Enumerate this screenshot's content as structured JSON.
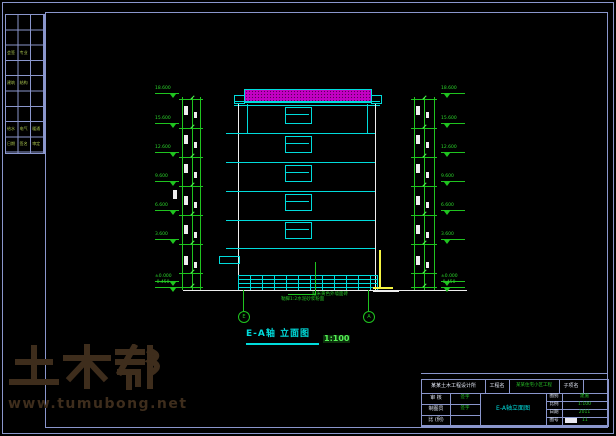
{
  "watermark": {
    "logo_text": "土木帮",
    "url_text": "www.tumubong.net",
    "color": "#3e2d1c"
  },
  "drawing": {
    "title": "E-A轴 立面图",
    "scale": "1:100",
    "levels_left": [
      "18.600",
      "15.600",
      "12.600",
      "9.600",
      "6.600",
      "3.600",
      "±0.000",
      "-0.450"
    ],
    "levels_right": [
      "18.600",
      "15.600",
      "12.600",
      "9.600",
      "6.600",
      "3.600",
      "±0.000",
      "-0.450"
    ],
    "axis_bubbles": [
      "E",
      "A"
    ],
    "material_notes": [
      "贴米黄色外墙面砖",
      "勒脚1:2水泥砂浆粉面"
    ],
    "colors": {
      "line_cyan": "#00dcdc",
      "line_green": "#1fc41f",
      "line_white": "#eeeeee",
      "roof_magenta": "#d400d4",
      "highlight_yellow": "#f5f542",
      "border_blue": "#8a96cc",
      "sidebar_text_green": "#a9c44e"
    }
  },
  "sidebar_table": {
    "green_cells": [
      {
        "row": 2,
        "col": 0,
        "text": "会签"
      },
      {
        "row": 2,
        "col": 1,
        "text": "专业"
      },
      {
        "row": 4,
        "col": 0,
        "text": "建筑"
      },
      {
        "row": 4,
        "col": 1,
        "text": "结构"
      },
      {
        "row": 7,
        "col": 0,
        "text": "给水"
      },
      {
        "row": 7,
        "col": 1,
        "text": "电气"
      },
      {
        "row": 7,
        "col": 2,
        "text": "暖通"
      },
      {
        "row": 8,
        "col": 0,
        "text": "日期"
      },
      {
        "row": 8,
        "col": 1,
        "text": "签名"
      },
      {
        "row": 8,
        "col": 2,
        "text": "审定"
      }
    ]
  },
  "title_block": {
    "unit_name": "某某土木工程设计所",
    "project_label": "工程名",
    "project_name": "某某住宅小区工程",
    "subproject_label": "子项名",
    "drawing_name": "E-A轴立面图",
    "left_rows": [
      {
        "label": "审 核",
        "value": "签字"
      },
      {
        "label": "制图员",
        "value": "签字"
      },
      {
        "label": "比 (例)",
        "value": ""
      }
    ],
    "right_rows": [
      {
        "label": "图别",
        "value": "建施"
      },
      {
        "label": "比例",
        "value": "1:100"
      },
      {
        "label": "日期",
        "value": "2011"
      },
      {
        "label": "图号",
        "value": "11"
      }
    ]
  }
}
